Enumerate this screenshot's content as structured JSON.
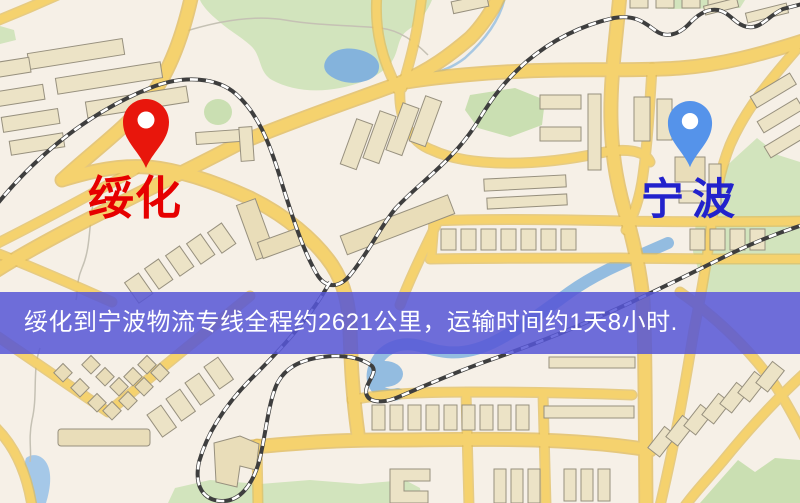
{
  "markers": {
    "origin": {
      "name": "绥化",
      "pin_color": "#e8160c",
      "label_color": "#e60000"
    },
    "destination": {
      "name": "宁波",
      "pin_color": "#5593ea",
      "label_color": "#2222cc"
    }
  },
  "banner": {
    "text": "绥化到宁波物流专线全程约2621公里，运输时间约1天8小时.",
    "background": "#5656d6",
    "text_color": "#ffffff"
  },
  "map_colors": {
    "background": "#f6f0e7",
    "road": "#f5d26e",
    "road_casing": "#dfba58",
    "building": "#ece3c6",
    "green_area": "#d2e4bd",
    "water": "#84b3dc",
    "railway": "#3e3e3e"
  }
}
